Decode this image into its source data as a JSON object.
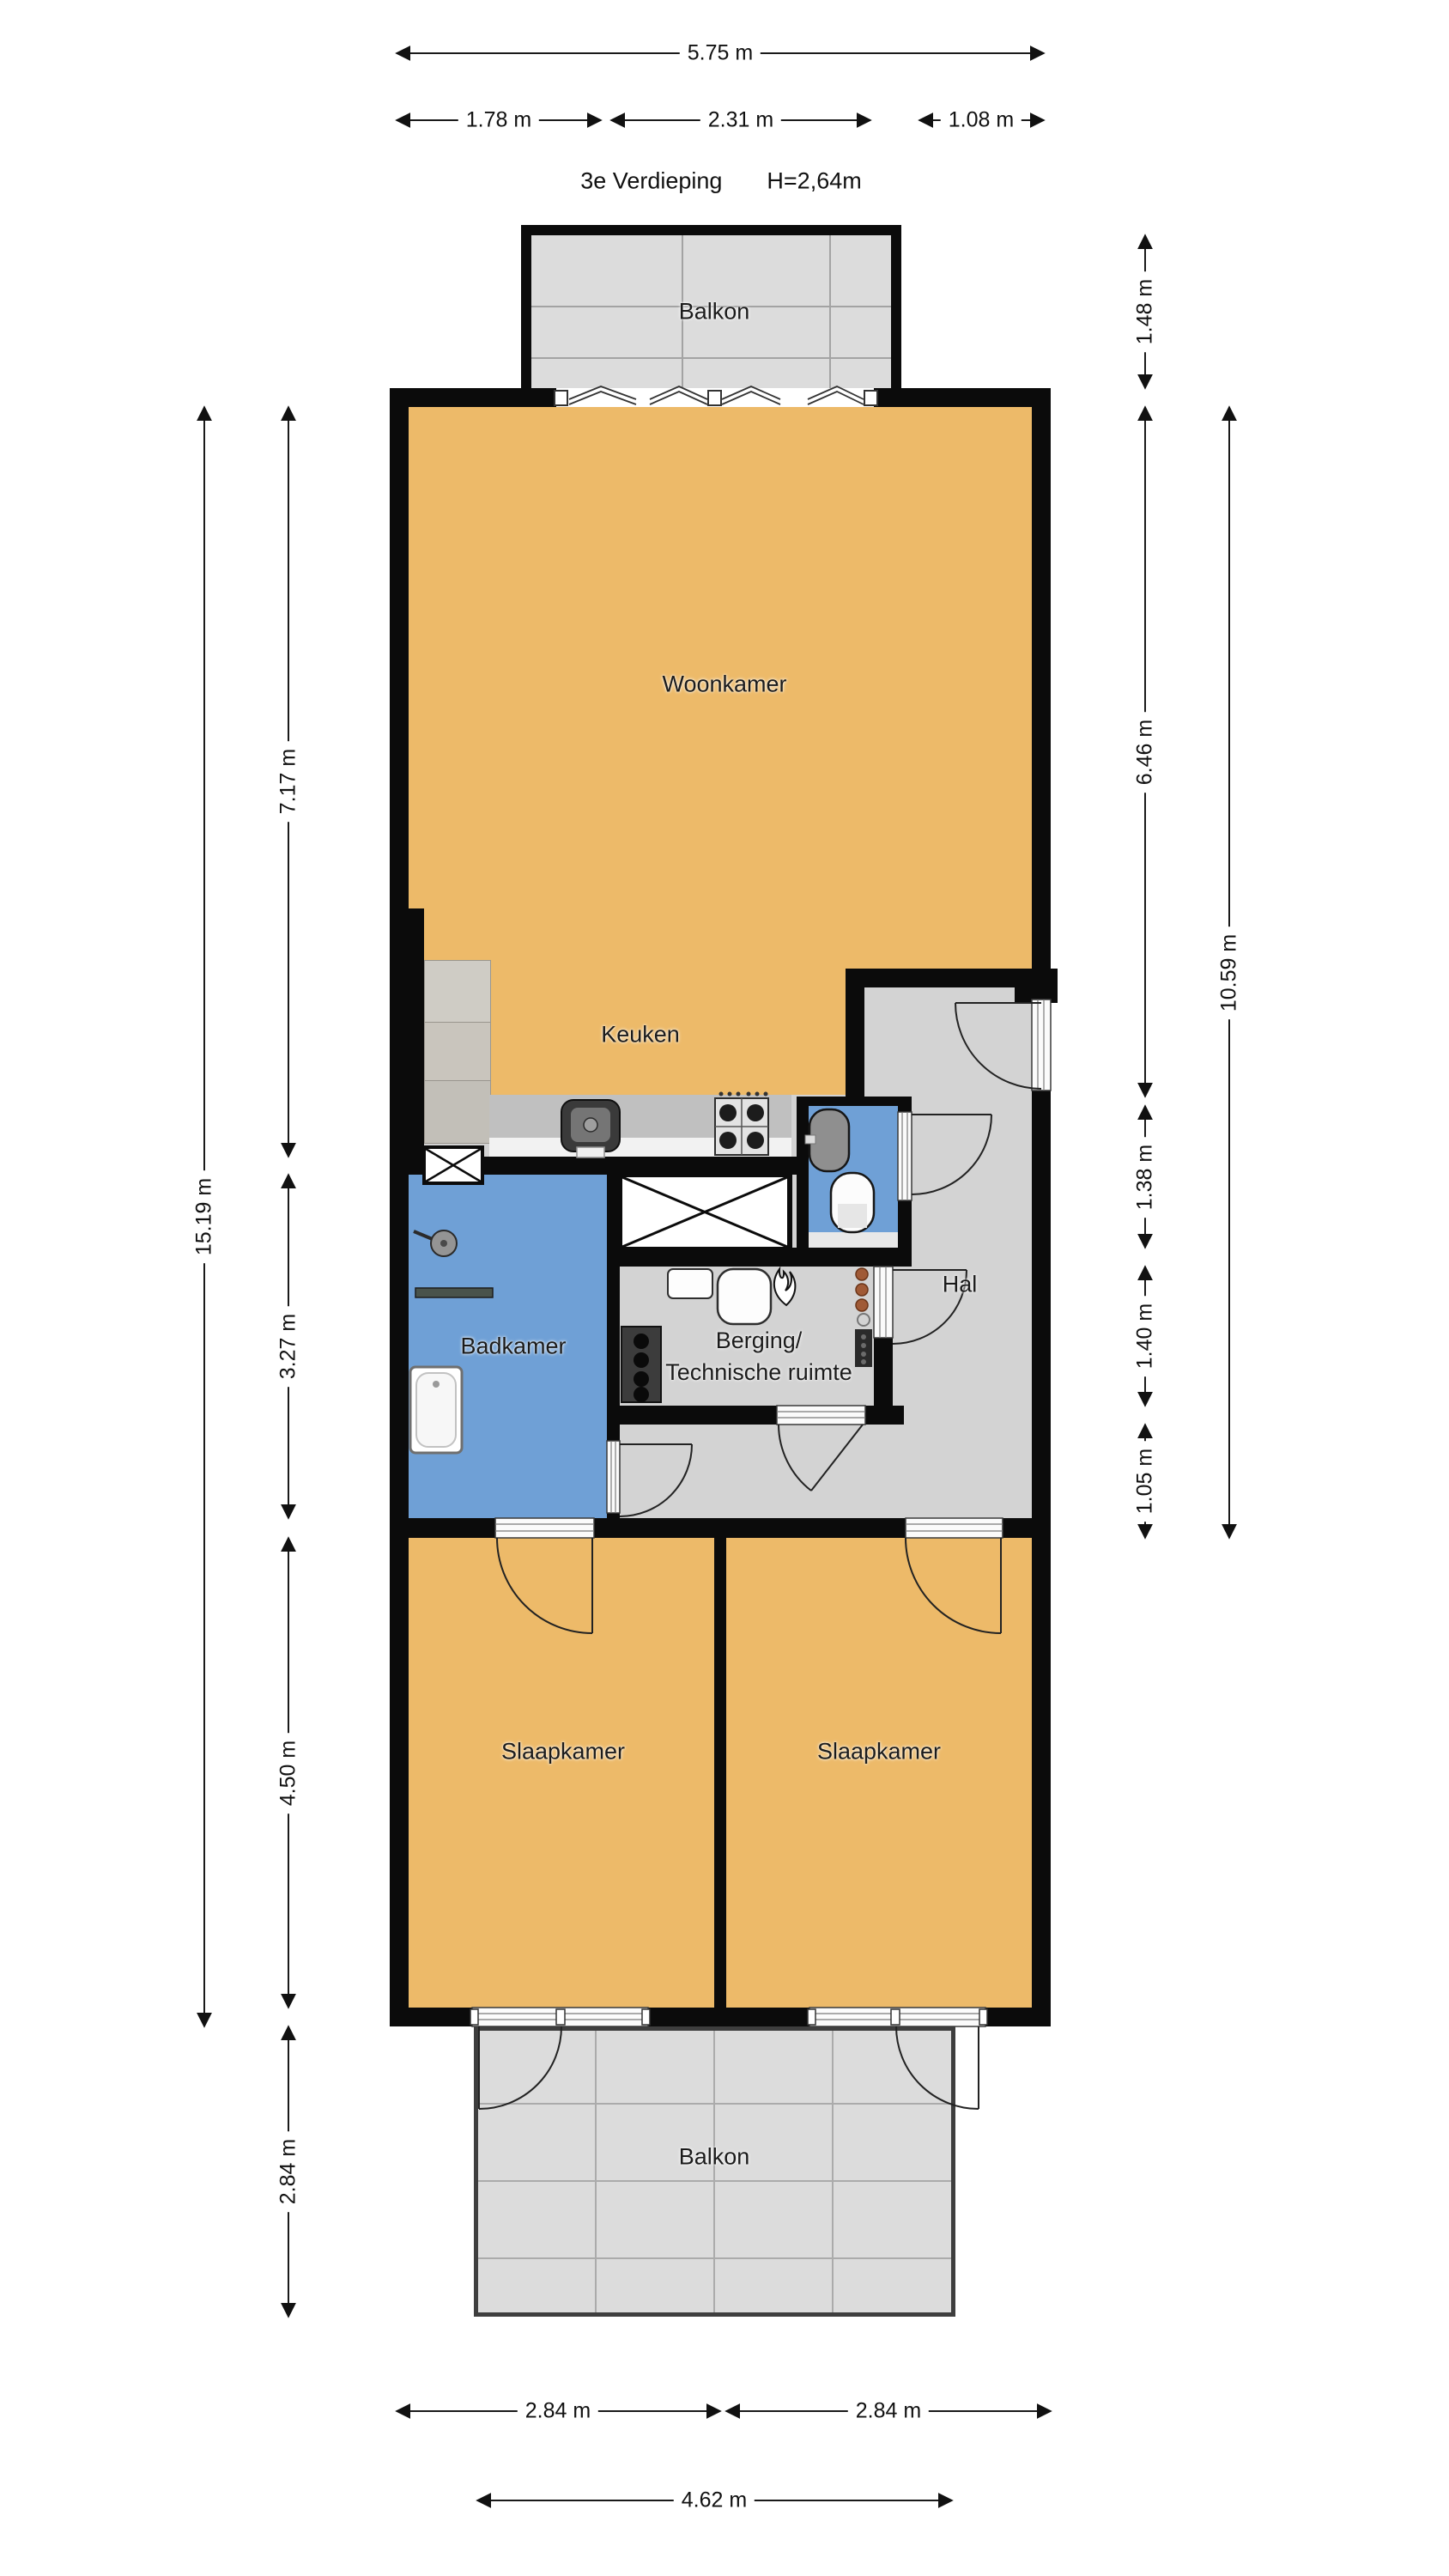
{
  "floorplan": {
    "title": "3e Verdieping",
    "ceiling_height": "H=2,64m",
    "rooms": {
      "balkon_top": "Balkon",
      "woonkamer": "Woonkamer",
      "keuken": "Keuken",
      "badkamer": "Badkamer",
      "hal": "Hal",
      "berging_line1": "Berging/",
      "berging_line2": "Technische ruimte",
      "slaapkamer_left": "Slaapkamer",
      "slaapkamer_right": "Slaapkamer",
      "balkon_bottom": "Balkon"
    },
    "dimensions": {
      "top_total": "5.75 m",
      "top_left_section": "1.78 m",
      "top_middle_section": "2.31 m",
      "top_right_section": "1.08 m",
      "right_balkon": "1.48 m",
      "right_woonkamer": "6.46 m",
      "right_total": "10.59 m",
      "right_toilet": "1.38 m",
      "right_berging": "1.40 m",
      "right_hal": "1.05 m",
      "left_total": "15.19 m",
      "left_woonkamer": "7.17 m",
      "left_badkamer": "3.27 m",
      "left_slaapkamer": "4.50 m",
      "left_balkon": "2.84 m",
      "bottom_left_slaapkamer": "2.84 m",
      "bottom_right_slaapkamer": "2.84 m",
      "bottom_balkon": "4.62 m"
    },
    "colors": {
      "room_orange": "#EDBA69",
      "wet_blue": "#6FA0D6",
      "hall_gray": "#D3D3D3",
      "balcony_gray": "#DCDCDC",
      "counter_gray": "#C0C0C0",
      "wall_black": "#0B0B0B"
    }
  }
}
